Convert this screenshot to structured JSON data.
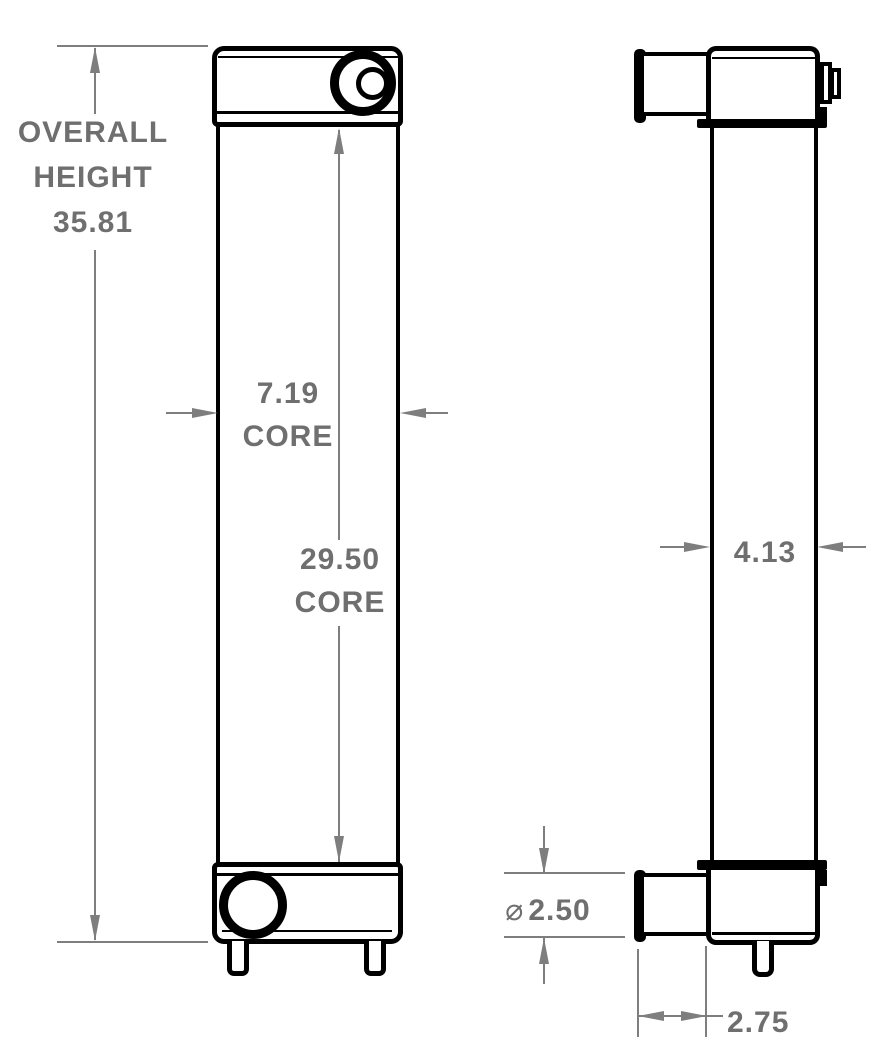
{
  "drawing": {
    "type": "radiator-dimension-drawing",
    "views": [
      {
        "id": "front-view",
        "description": "front elevation of radiator"
      },
      {
        "id": "side-view",
        "description": "side elevation of radiator"
      }
    ],
    "dimensions": {
      "overall_height": {
        "line1": "OVERALL",
        "line2": "HEIGHT",
        "value": "35.81"
      },
      "core_width": {
        "value": "7.19",
        "label": "CORE"
      },
      "core_height": {
        "value": "29.50",
        "label": "CORE"
      },
      "core_depth": {
        "value": "4.13"
      },
      "outlet_diameter": {
        "symbol": "⌀",
        "value": "2.50"
      },
      "outlet_pipe_length": {
        "value": "2.75"
      }
    },
    "colors": {
      "outline": "#000000",
      "dimension_line": "#7e7e7e",
      "dimension_text": "#6f6f6f",
      "background": "#ffffff"
    }
  }
}
